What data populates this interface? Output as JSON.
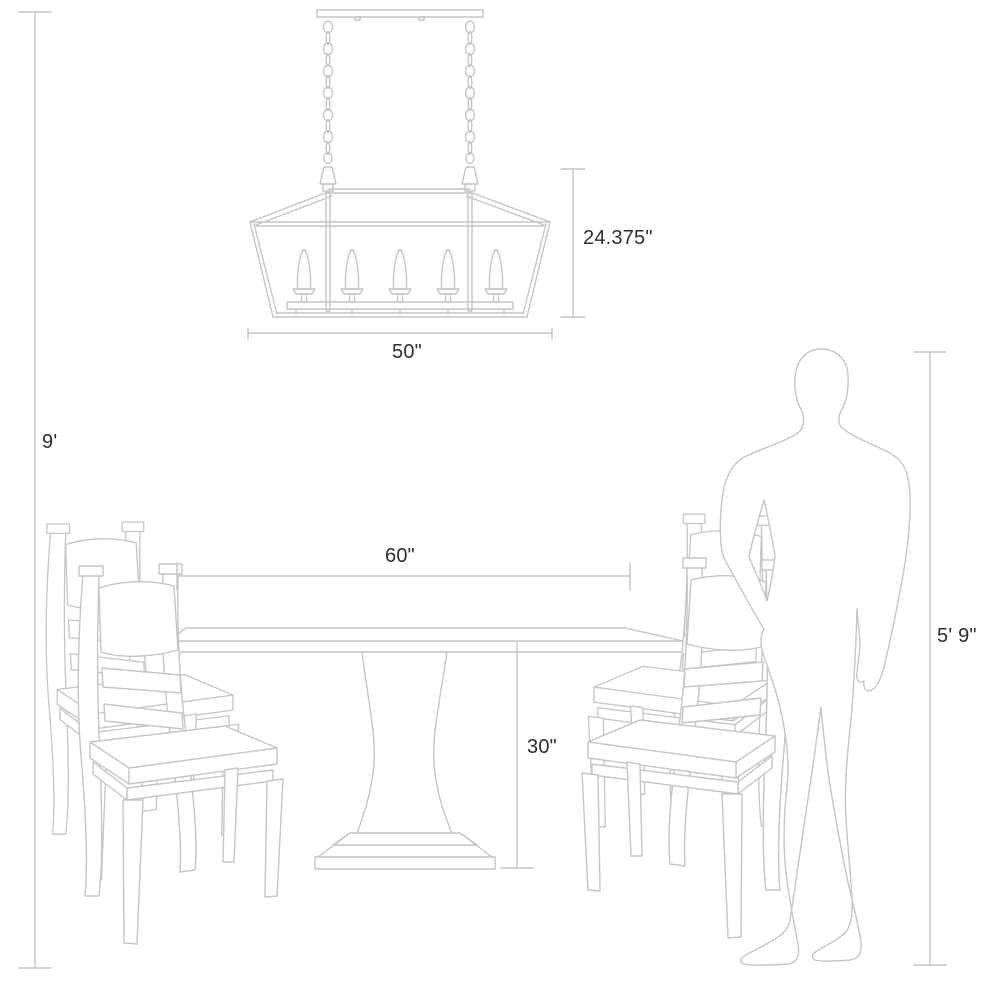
{
  "diagram": {
    "title": "product-dimension-diagram",
    "scene": "linear-chandelier-above-pedestal-dining-table-with-four-chairs-and-human-figure",
    "background_color": "#ffffff",
    "line_color": "#c2c6c8",
    "label_color": "#2d2d2f",
    "objects": {
      "chandelier": "linear-lantern-chandelier-five-candles",
      "table": "pedestal-dining-table",
      "chairs": "four-ladder-back-dining-chairs",
      "person": "standing-human-silhouette"
    },
    "annotations": {
      "ceiling_height": {
        "label": "9'"
      },
      "fixture_height": {
        "label": "24.375\""
      },
      "fixture_width": {
        "label": "50\""
      },
      "table_width": {
        "label": "60\""
      },
      "table_height": {
        "label": "30\""
      },
      "person_height": {
        "label": "5' 9\""
      }
    }
  }
}
